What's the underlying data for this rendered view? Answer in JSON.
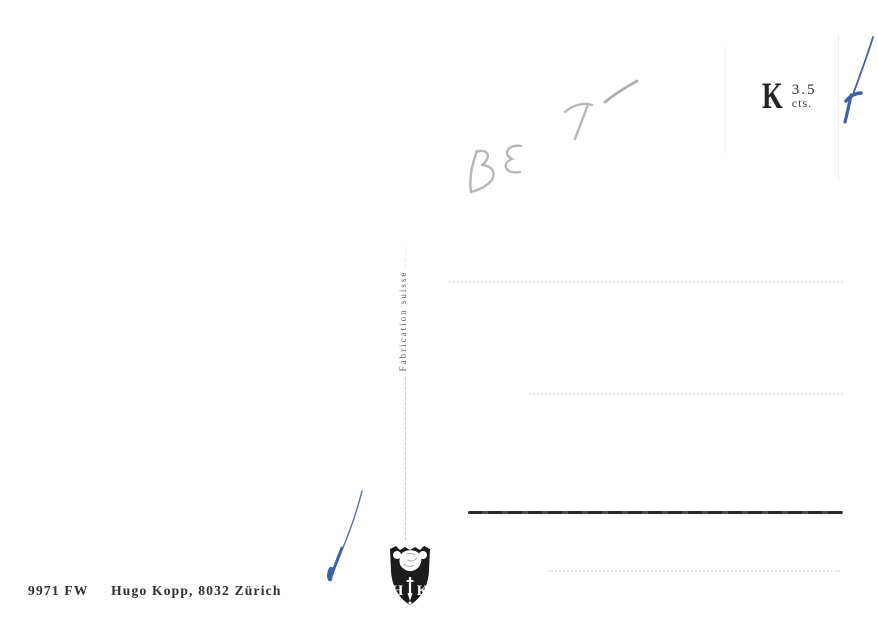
{
  "card": {
    "type_note": "postcard back (scanned)",
    "stamp": {
      "currency_letter": "K",
      "value": "3.5",
      "unit": "cts."
    },
    "divider": {
      "label": "Fabrication suisse"
    },
    "imprint": {
      "code": "9971 FW",
      "publisher": "Hugo Kopp, 8032 Zürich"
    },
    "handwriting": {
      "pencil_note": "BE 7 —",
      "tool": "pencil"
    },
    "pen_marks": {
      "description": "two diagonal ballpoint strokes",
      "color": "#3f63a2"
    },
    "logo": {
      "left_initial": "H",
      "right_initial": "K"
    },
    "colors": {
      "background": "#ffffff",
      "ink": "#2e2e2e",
      "pencil": "#b6b6b6",
      "pen_blue": "#3f63a2",
      "faint_guide_line": "#e7e7e7",
      "divider_line": "#c9c9c9",
      "message_line": "#2a2a2a"
    }
  }
}
